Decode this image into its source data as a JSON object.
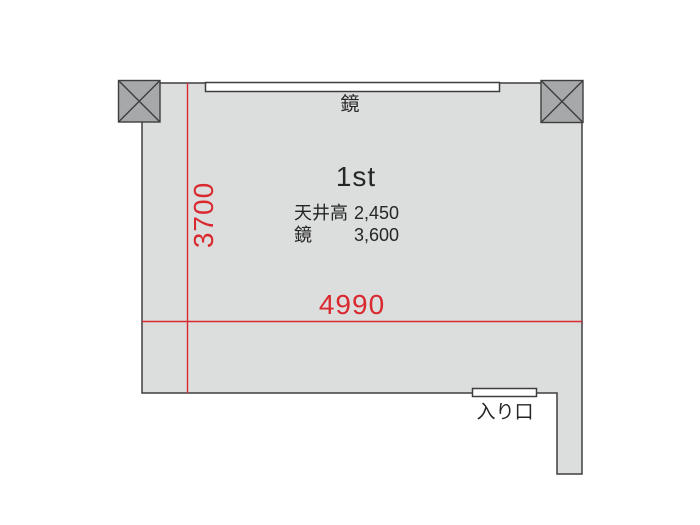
{
  "floorplan": {
    "room_title": "1st",
    "mirror_label": "鏡",
    "entrance_label": "入り口",
    "dimensions": {
      "width_mm": "4990",
      "depth_mm": "3700"
    },
    "specs": [
      {
        "label": "天井高",
        "value": "2,450"
      },
      {
        "label": "鏡",
        "value": "3,600"
      }
    ],
    "colors": {
      "floor": "#dcdddd",
      "pillar": "#a7a8aa",
      "outline": "#3e3e40",
      "dimension_red": "#d9292f",
      "text": "#262626"
    }
  }
}
